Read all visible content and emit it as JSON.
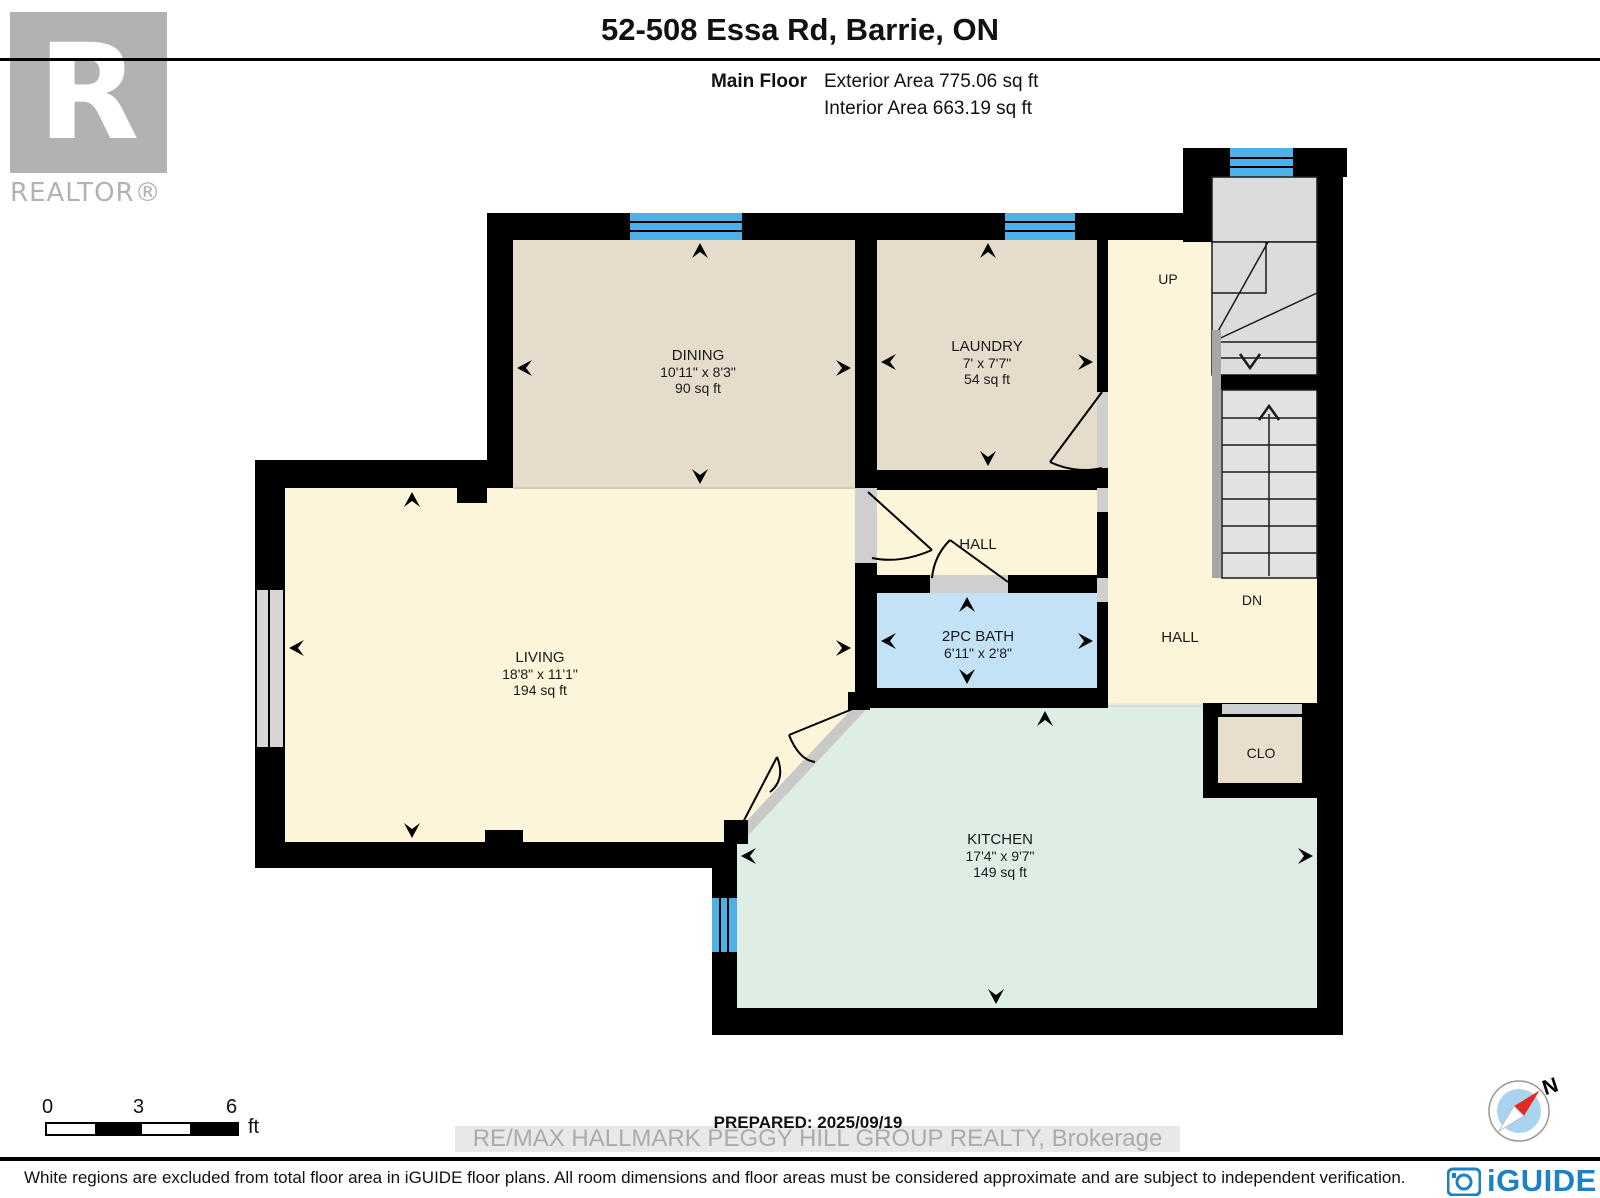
{
  "header": {
    "title": "52-508 Essa Rd, Barrie, ON",
    "floor_label": "Main Floor",
    "exterior_area": "Exterior Area 775.06 sq ft",
    "interior_area": "Interior Area 663.19 sq ft"
  },
  "branding": {
    "realtor_letter": "R",
    "realtor_text": "REALTOR®",
    "watermark": "RE/MAX HALLMARK PEGGY HILL GROUP REALTY, Brokerage",
    "iguide_text": "iGUIDE",
    "iguide_blue": "#1d82c5",
    "logo_gray": "#b2b2b2"
  },
  "rooms": {
    "dining": {
      "name": "DINING",
      "dims": "10'11\" x 8'3\"",
      "area": "90 sq ft"
    },
    "laundry": {
      "name": "LAUNDRY",
      "dims": "7' x 7'7\"",
      "area": "54 sq ft"
    },
    "living": {
      "name": "LIVING",
      "dims": "18'8\" x 11'1\"",
      "area": "194 sq ft"
    },
    "bath": {
      "name": "2PC BATH",
      "dims": "6'11\" x 2'8\""
    },
    "kitchen": {
      "name": "KITCHEN",
      "dims": "17'4\" x 9'7\"",
      "area": "149 sq ft"
    },
    "hall_upper": {
      "name": "HALL"
    },
    "hall_lower": {
      "name": "HALL"
    },
    "closet": {
      "name": "CLO"
    }
  },
  "stairs": {
    "up": "UP",
    "dn": "DN"
  },
  "scale_bar": {
    "tick0": "0",
    "tick1": "3",
    "tick2": "6",
    "unit": "ft"
  },
  "footer": {
    "prepared": "PREPARED: 2025/09/19",
    "disclaimer": "White regions are excluded from total floor area in iGUIDE floor plans. All room dimensions and floor areas must be considered approximate and are subject to independent verification.",
    "compass_north": "N"
  },
  "colors": {
    "wall": "#000000",
    "dining_laundry_floor": "#e5dccc",
    "living_hall_floor": "#fcf5da",
    "bath_floor": "#c3e2f5",
    "kitchen_floor": "#dfeee5",
    "closet_floor": "#e9ddce",
    "window_blue": "#4db1e8",
    "stair_gray": "#dcdcdc",
    "watermark_gray": "#ababab"
  }
}
